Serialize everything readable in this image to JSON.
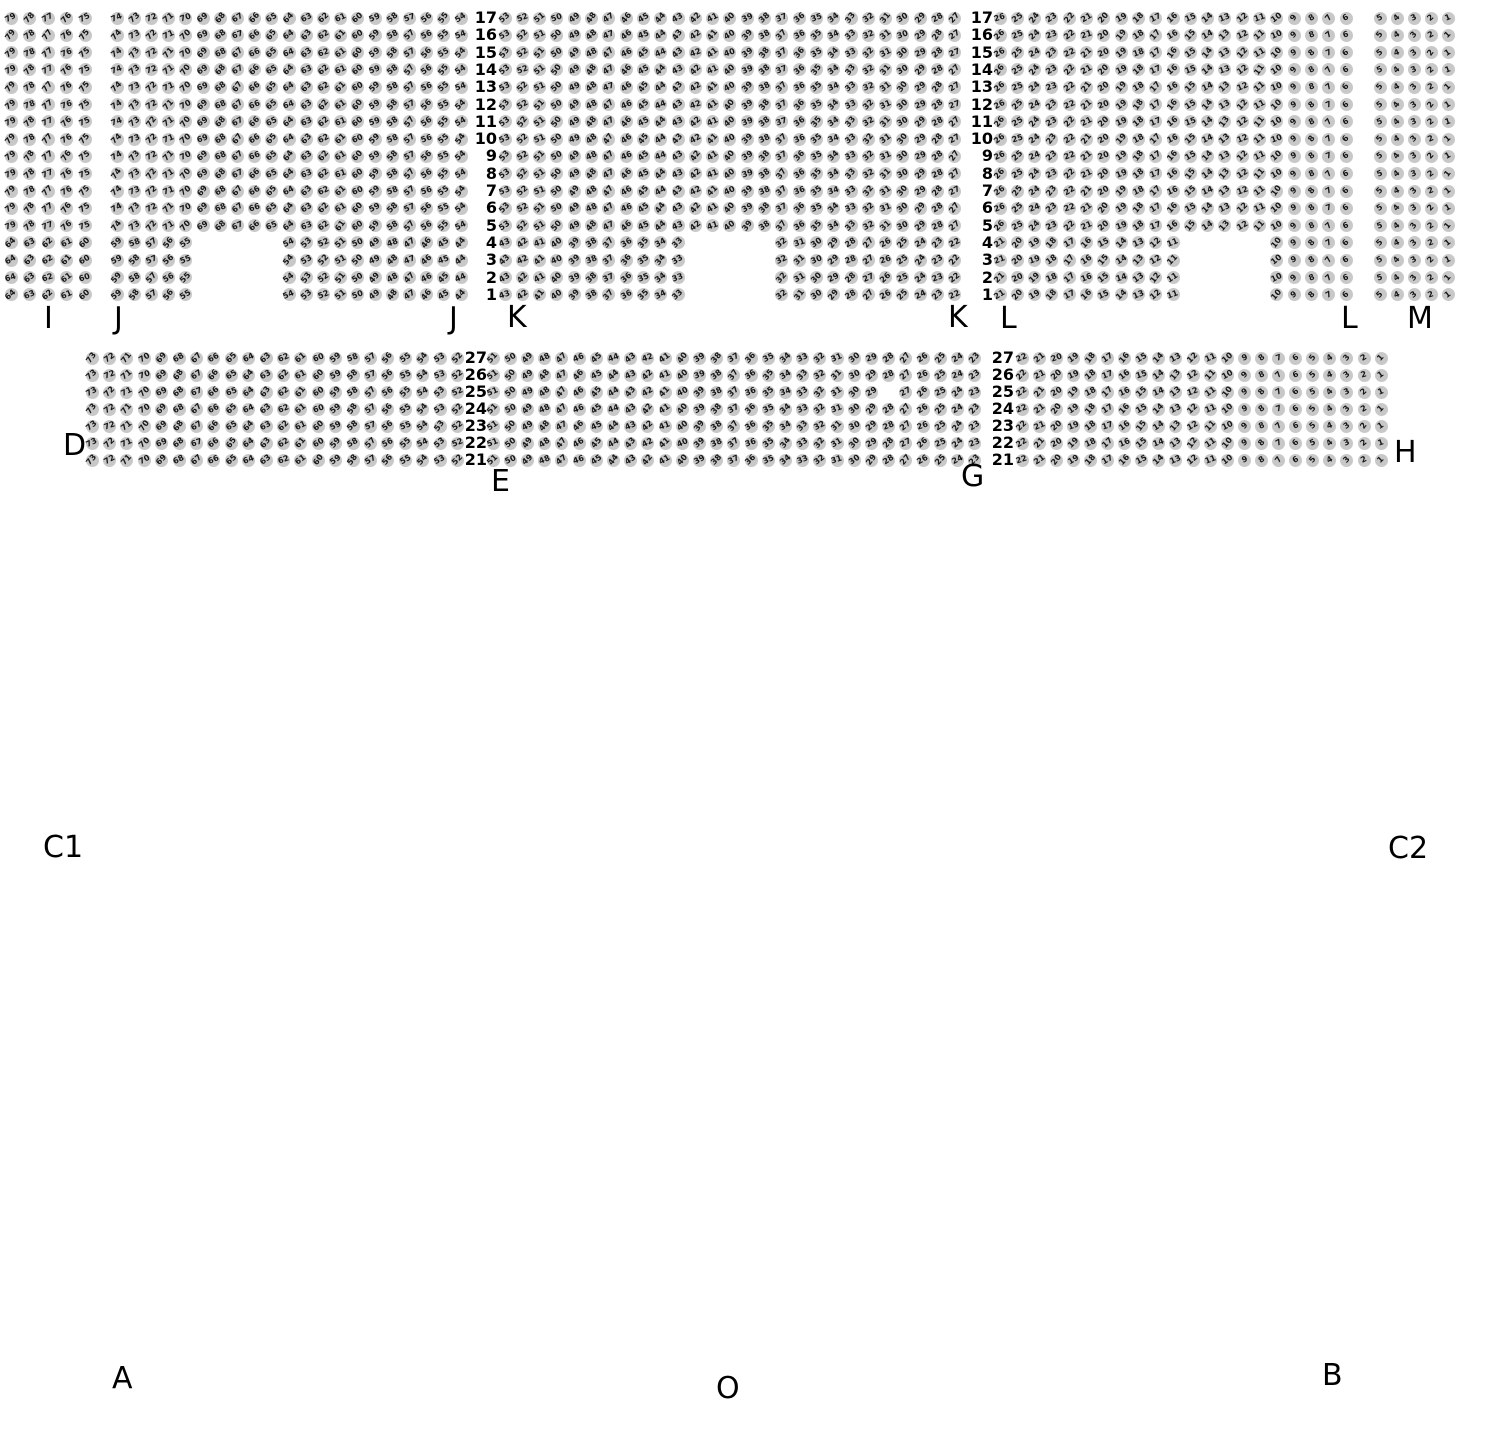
{
  "colors": {
    "background": "#ffffff",
    "seat_fill": "#c8c8c8",
    "seat_number_text": "#161616",
    "label_text": "#000000"
  },
  "seat_map": {
    "numbering_rule": "seats are numbered within each physical row from right to left, rightmost seat = 1; rows with notches renumber sequentially over present seats; holes keep their positional number skipped",
    "bands": [
      {
        "name": "upper-band",
        "rows_top_to_bottom": [
          17,
          16,
          15,
          14,
          13,
          12,
          11,
          10,
          9,
          8,
          7,
          6,
          5,
          4,
          3,
          2,
          1
        ],
        "row_y_top": 18,
        "row_spacing": 17.3,
        "short_rows": [
          4,
          3,
          2,
          1
        ],
        "row_label_columns": [
          {
            "right_x": 497
          },
          {
            "right_x": 993
          }
        ],
        "segments": [
          {
            "section": "I",
            "x_start": 11,
            "cols": 5,
            "col_spacing": 18.5
          },
          {
            "section": "J",
            "x_start": 117,
            "cols": 21,
            "col_spacing": 17.2,
            "notch_missing_cols": [
              6,
              10
            ]
          },
          {
            "section": "K",
            "x_start": 505,
            "cols": 27,
            "col_spacing": 17.3,
            "notch_missing_cols": [
              12,
              16
            ]
          },
          {
            "section": "L",
            "x_start": 1000,
            "cols": 21,
            "col_spacing": 17.3,
            "notch_missing_cols": [
              12,
              16
            ]
          },
          {
            "section": "M",
            "x_start": 1380,
            "cols": 5,
            "col_spacing": 17
          }
        ]
      },
      {
        "name": "lower-band",
        "rows_top_to_bottom": [
          27,
          26,
          25,
          24,
          23,
          22,
          21
        ],
        "row_y_top": 358,
        "row_spacing": 17,
        "short_rows": [],
        "row_label_columns": [
          {
            "right_x": 487
          },
          {
            "right_x": 1014
          }
        ],
        "segments": [
          {
            "section": "D",
            "x_start": 92,
            "cols": 22,
            "col_spacing": 17.4
          },
          {
            "section": "EG",
            "x_start": 493,
            "cols": 29,
            "col_spacing": 17.2,
            "holes": [
              {
                "row": 25,
                "col": 24
              }
            ]
          },
          {
            "section": "H",
            "x_start": 1022,
            "cols": 22,
            "col_spacing": 17.1
          }
        ]
      }
    ],
    "section_labels": [
      {
        "text": "I",
        "x": 44,
        "y": 302
      },
      {
        "text": "J",
        "x": 114,
        "y": 302
      },
      {
        "text": "J",
        "x": 449,
        "y": 302
      },
      {
        "text": "K",
        "x": 507,
        "y": 301
      },
      {
        "text": "K",
        "x": 948,
        "y": 301
      },
      {
        "text": "L",
        "x": 1000,
        "y": 302
      },
      {
        "text": "L",
        "x": 1341,
        "y": 302
      },
      {
        "text": "M",
        "x": 1407,
        "y": 302
      },
      {
        "text": "D",
        "x": 63,
        "y": 429
      },
      {
        "text": "E",
        "x": 491,
        "y": 465
      },
      {
        "text": "G",
        "x": 961,
        "y": 460
      },
      {
        "text": "H",
        "x": 1394,
        "y": 436
      }
    ],
    "area_labels": [
      {
        "text": "C1",
        "x": 43,
        "y": 831
      },
      {
        "text": "C2",
        "x": 1388,
        "y": 832
      },
      {
        "text": "A",
        "x": 112,
        "y": 1362
      },
      {
        "text": "O",
        "x": 716,
        "y": 1372
      },
      {
        "text": "B",
        "x": 1322,
        "y": 1359
      }
    ]
  }
}
